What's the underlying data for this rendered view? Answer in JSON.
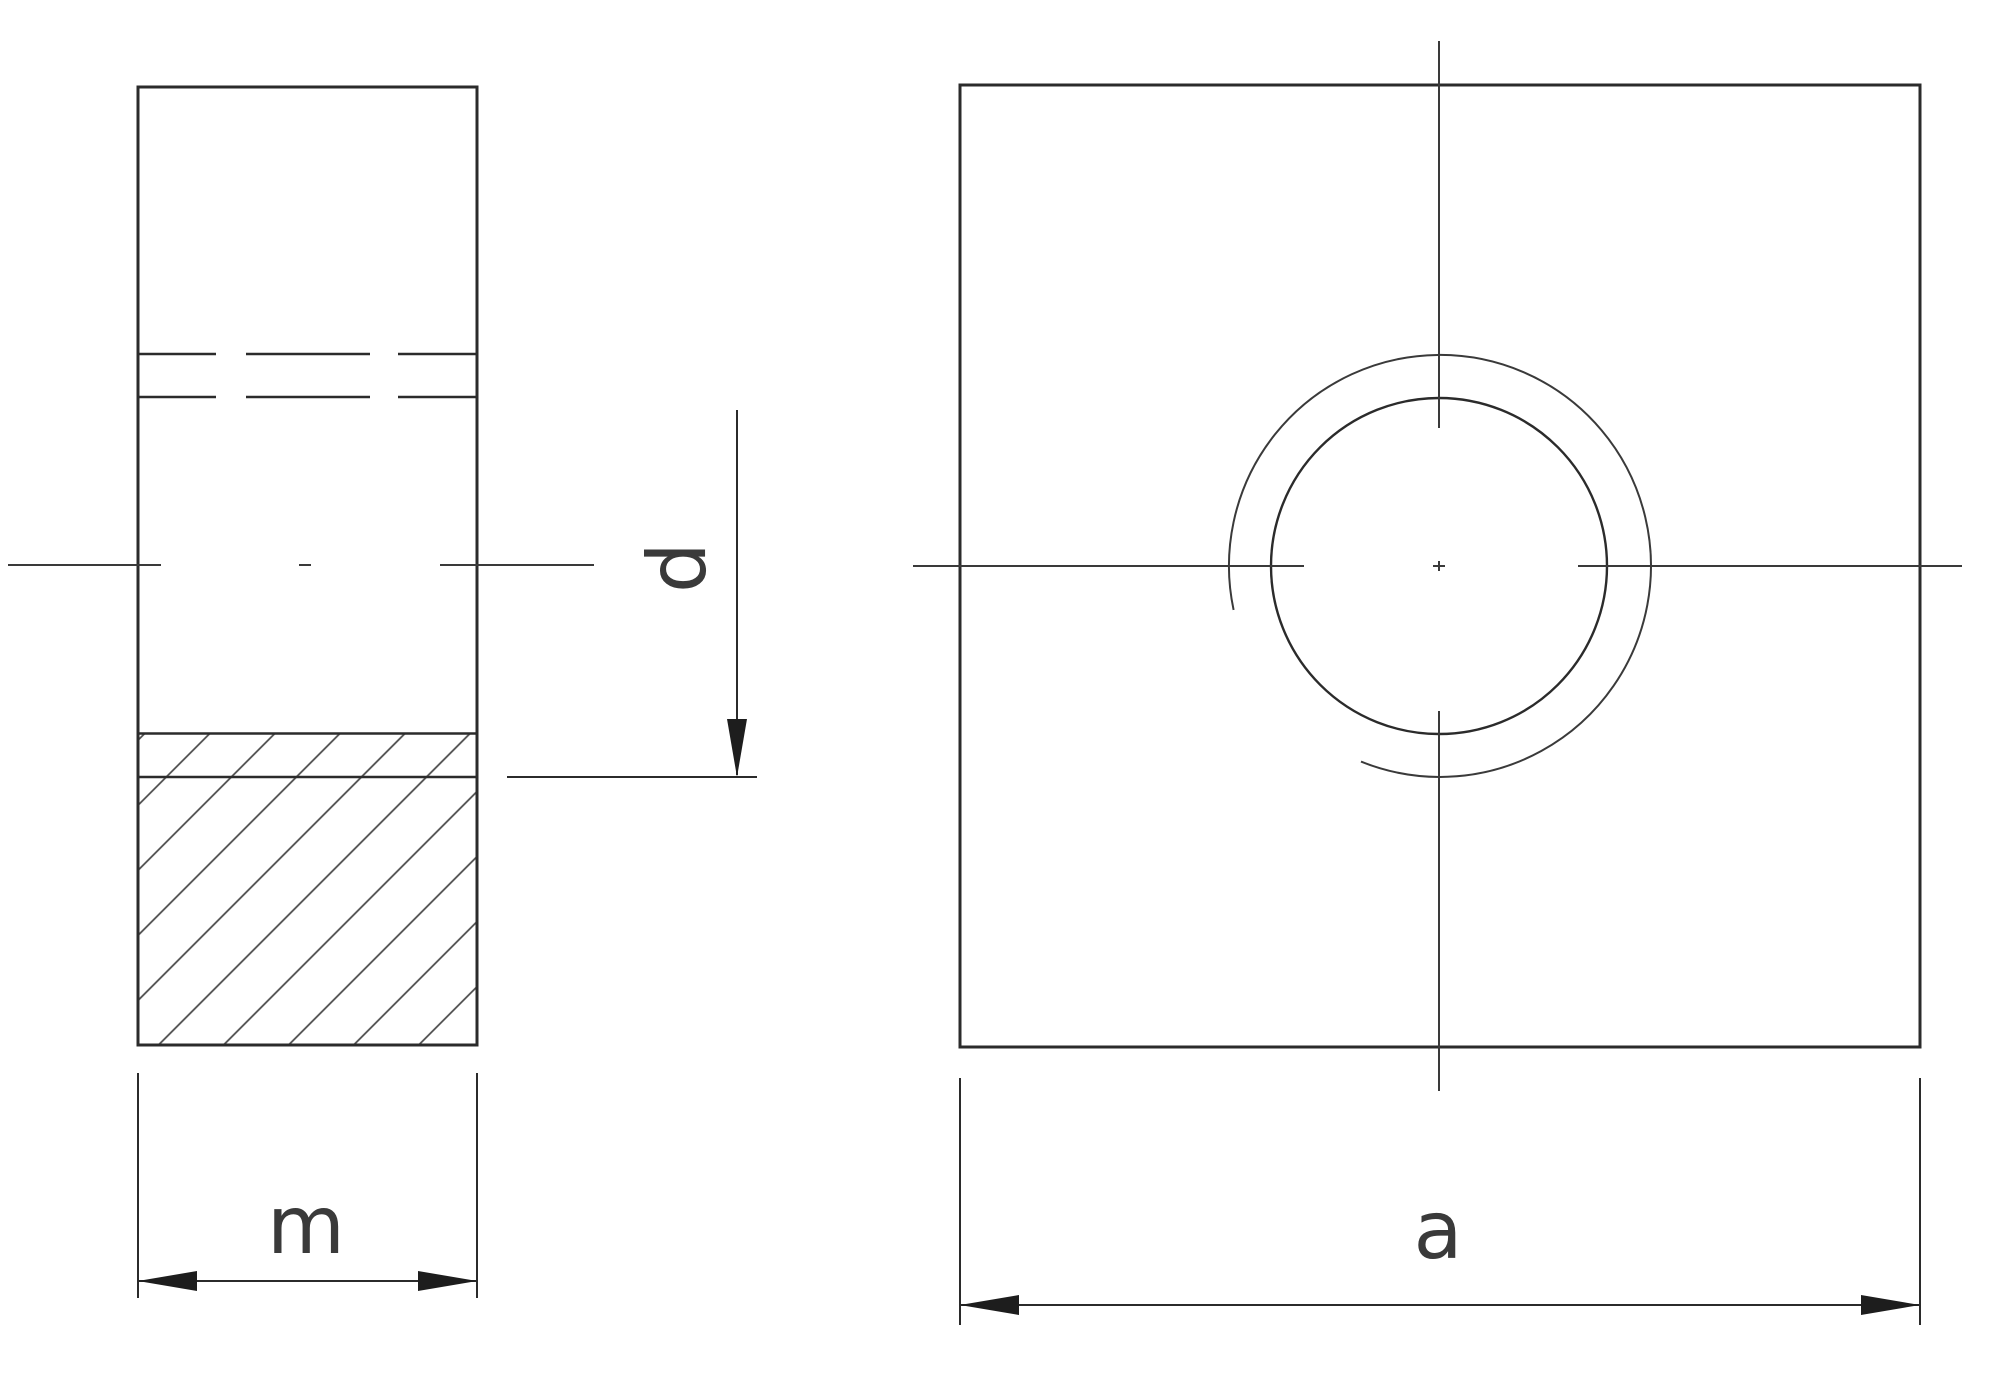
{
  "drawing": {
    "labels": {
      "m": "m",
      "d": "d",
      "a": "a"
    },
    "colors": {
      "line": "#2b2b2b",
      "hatch": "#4a4a4a",
      "background": "#ffffff",
      "arrow_fill": "#1d1d1d"
    }
  }
}
